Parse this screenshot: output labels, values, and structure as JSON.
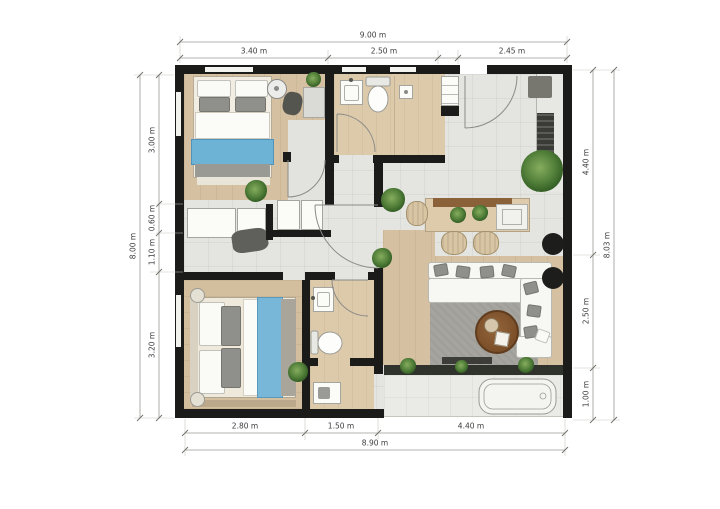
{
  "dimensions": {
    "top": {
      "total": "9.00 m",
      "segments": [
        "3.40 m",
        "2.50 m",
        "2.45 m"
      ]
    },
    "left": {
      "total": "8.00 m",
      "segments": [
        "3.00 m",
        "0.60 m",
        "1.10 m",
        "3.20 m"
      ]
    },
    "right": {
      "total": "8.03 m",
      "segments": [
        "4.40 m",
        "2.50 m",
        "1.00 m"
      ]
    },
    "bottom": {
      "total": "8.90 m",
      "segments": [
        "2.80 m",
        "1.50 m",
        "4.40 m"
      ]
    }
  },
  "colors": {
    "wall": "#1b1b19",
    "wood_floor": "#d5c1a1",
    "bath_floor": "#dccaab",
    "tile_floor": "#e4e4e0",
    "accent_blue": "#6db3d6",
    "bed2_blue": "#79b7d9",
    "plant_green": "#53803a",
    "rug_gray": "#a5a49e",
    "coffee_table_brown": "#7a4e28"
  }
}
